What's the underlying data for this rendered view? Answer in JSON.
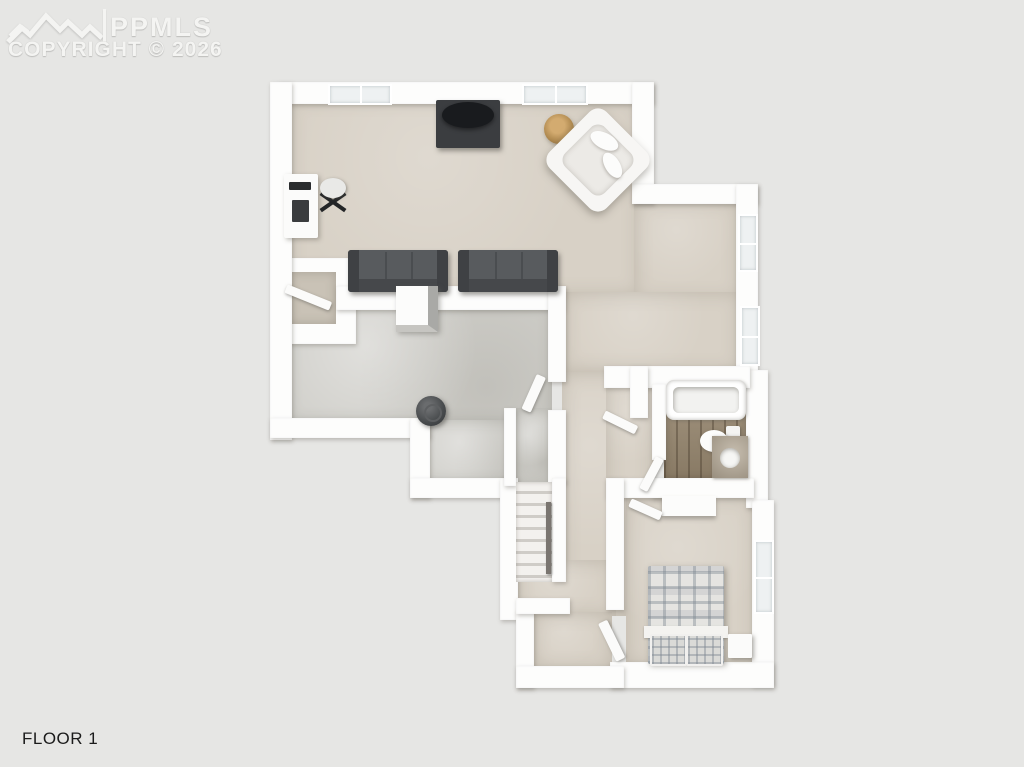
{
  "watermark": {
    "brand": "PPMLS",
    "copyright": "COPYRIGHT © 2026",
    "logo": "mountain-peaks"
  },
  "meta": {
    "floor_label": "FLOOR 1"
  },
  "plan": {
    "type": "3d-top-down-floor-plan",
    "rooms": [
      {
        "name": "living-room",
        "floor": "carpet",
        "furniture": [
          "tv-console",
          "television",
          "armchair",
          "throw-pillows",
          "wicker-basket",
          "desk",
          "office-chair",
          "sofa",
          "sofa"
        ]
      },
      {
        "name": "closet",
        "floor": "carpet",
        "furniture": []
      },
      {
        "name": "unfinished-room",
        "floor": "concrete",
        "furniture": [
          "cabinet",
          "water-heater"
        ]
      },
      {
        "name": "hallway",
        "floor": "carpet",
        "furniture": [
          "staircase",
          "handrail"
        ]
      },
      {
        "name": "bathroom",
        "floor": "wood-plank",
        "furniture": [
          "bathtub",
          "toilet",
          "vanity-sink"
        ]
      },
      {
        "name": "bedroom",
        "floor": "carpet",
        "furniture": [
          "bed-plaid",
          "nightstand",
          "closet-shelf"
        ]
      },
      {
        "name": "entry-vestibule",
        "floor": "carpet",
        "furniture": []
      }
    ],
    "window_count": 5,
    "door_count": 6,
    "colors": {
      "background": "#e6e6e4",
      "wall": "#fdfdfc",
      "carpet": "#d8d1c6",
      "carpet_dark": "#c9c2b6",
      "concrete": "#d0cfca",
      "wood": "#97876f",
      "sofa": "#585b5e",
      "furniture_dark": "#3b3d40",
      "plaid_base": "#e5e4e1",
      "basket": "#b08a50",
      "watermark_text": "#f4f4f2",
      "label_text": "#1b1b1b"
    }
  }
}
